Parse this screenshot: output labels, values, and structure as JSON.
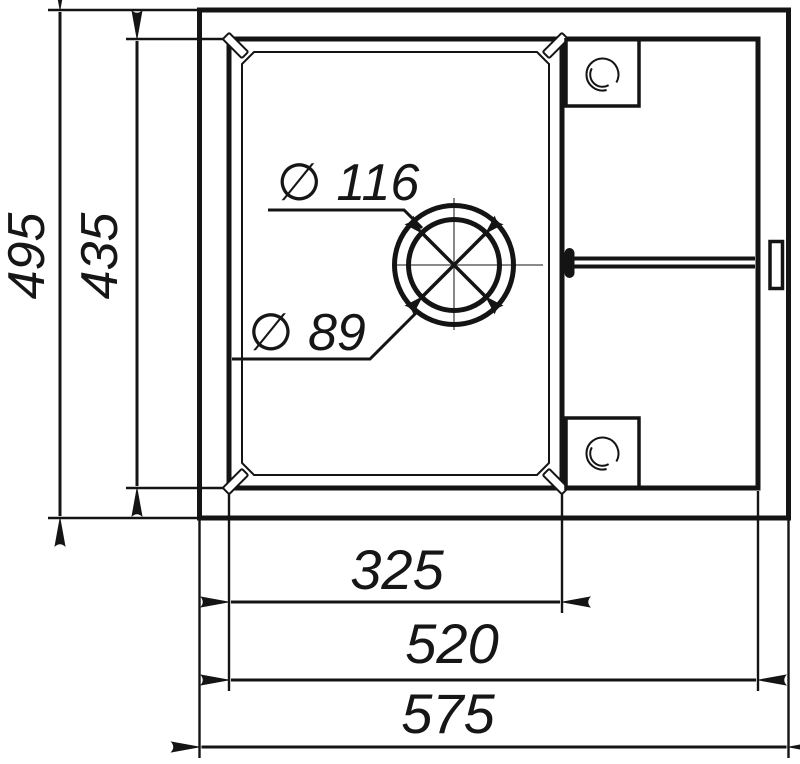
{
  "drawing": {
    "kind": "sink-top-view-technical-drawing",
    "dimensions": {
      "overall_depth": {
        "value": 495,
        "label": "495",
        "orientation": "vertical"
      },
      "bowl_depth": {
        "value": 435,
        "label": "435",
        "orientation": "vertical"
      },
      "bowl_width": {
        "value": 325,
        "label": "325",
        "orientation": "horizontal"
      },
      "inner_width": {
        "value": 520,
        "label": "520",
        "orientation": "horizontal"
      },
      "overall_width": {
        "value": 575,
        "label": "575",
        "orientation": "horizontal"
      },
      "drain_outer_diameter": {
        "value": 116,
        "label": "∅ 116"
      },
      "drain_inner_diameter": {
        "value": 89,
        "label": "∅ 89"
      }
    },
    "colors": {
      "line": "#141414",
      "centerline": "#7a7a7a",
      "background": "#ffffff"
    }
  }
}
